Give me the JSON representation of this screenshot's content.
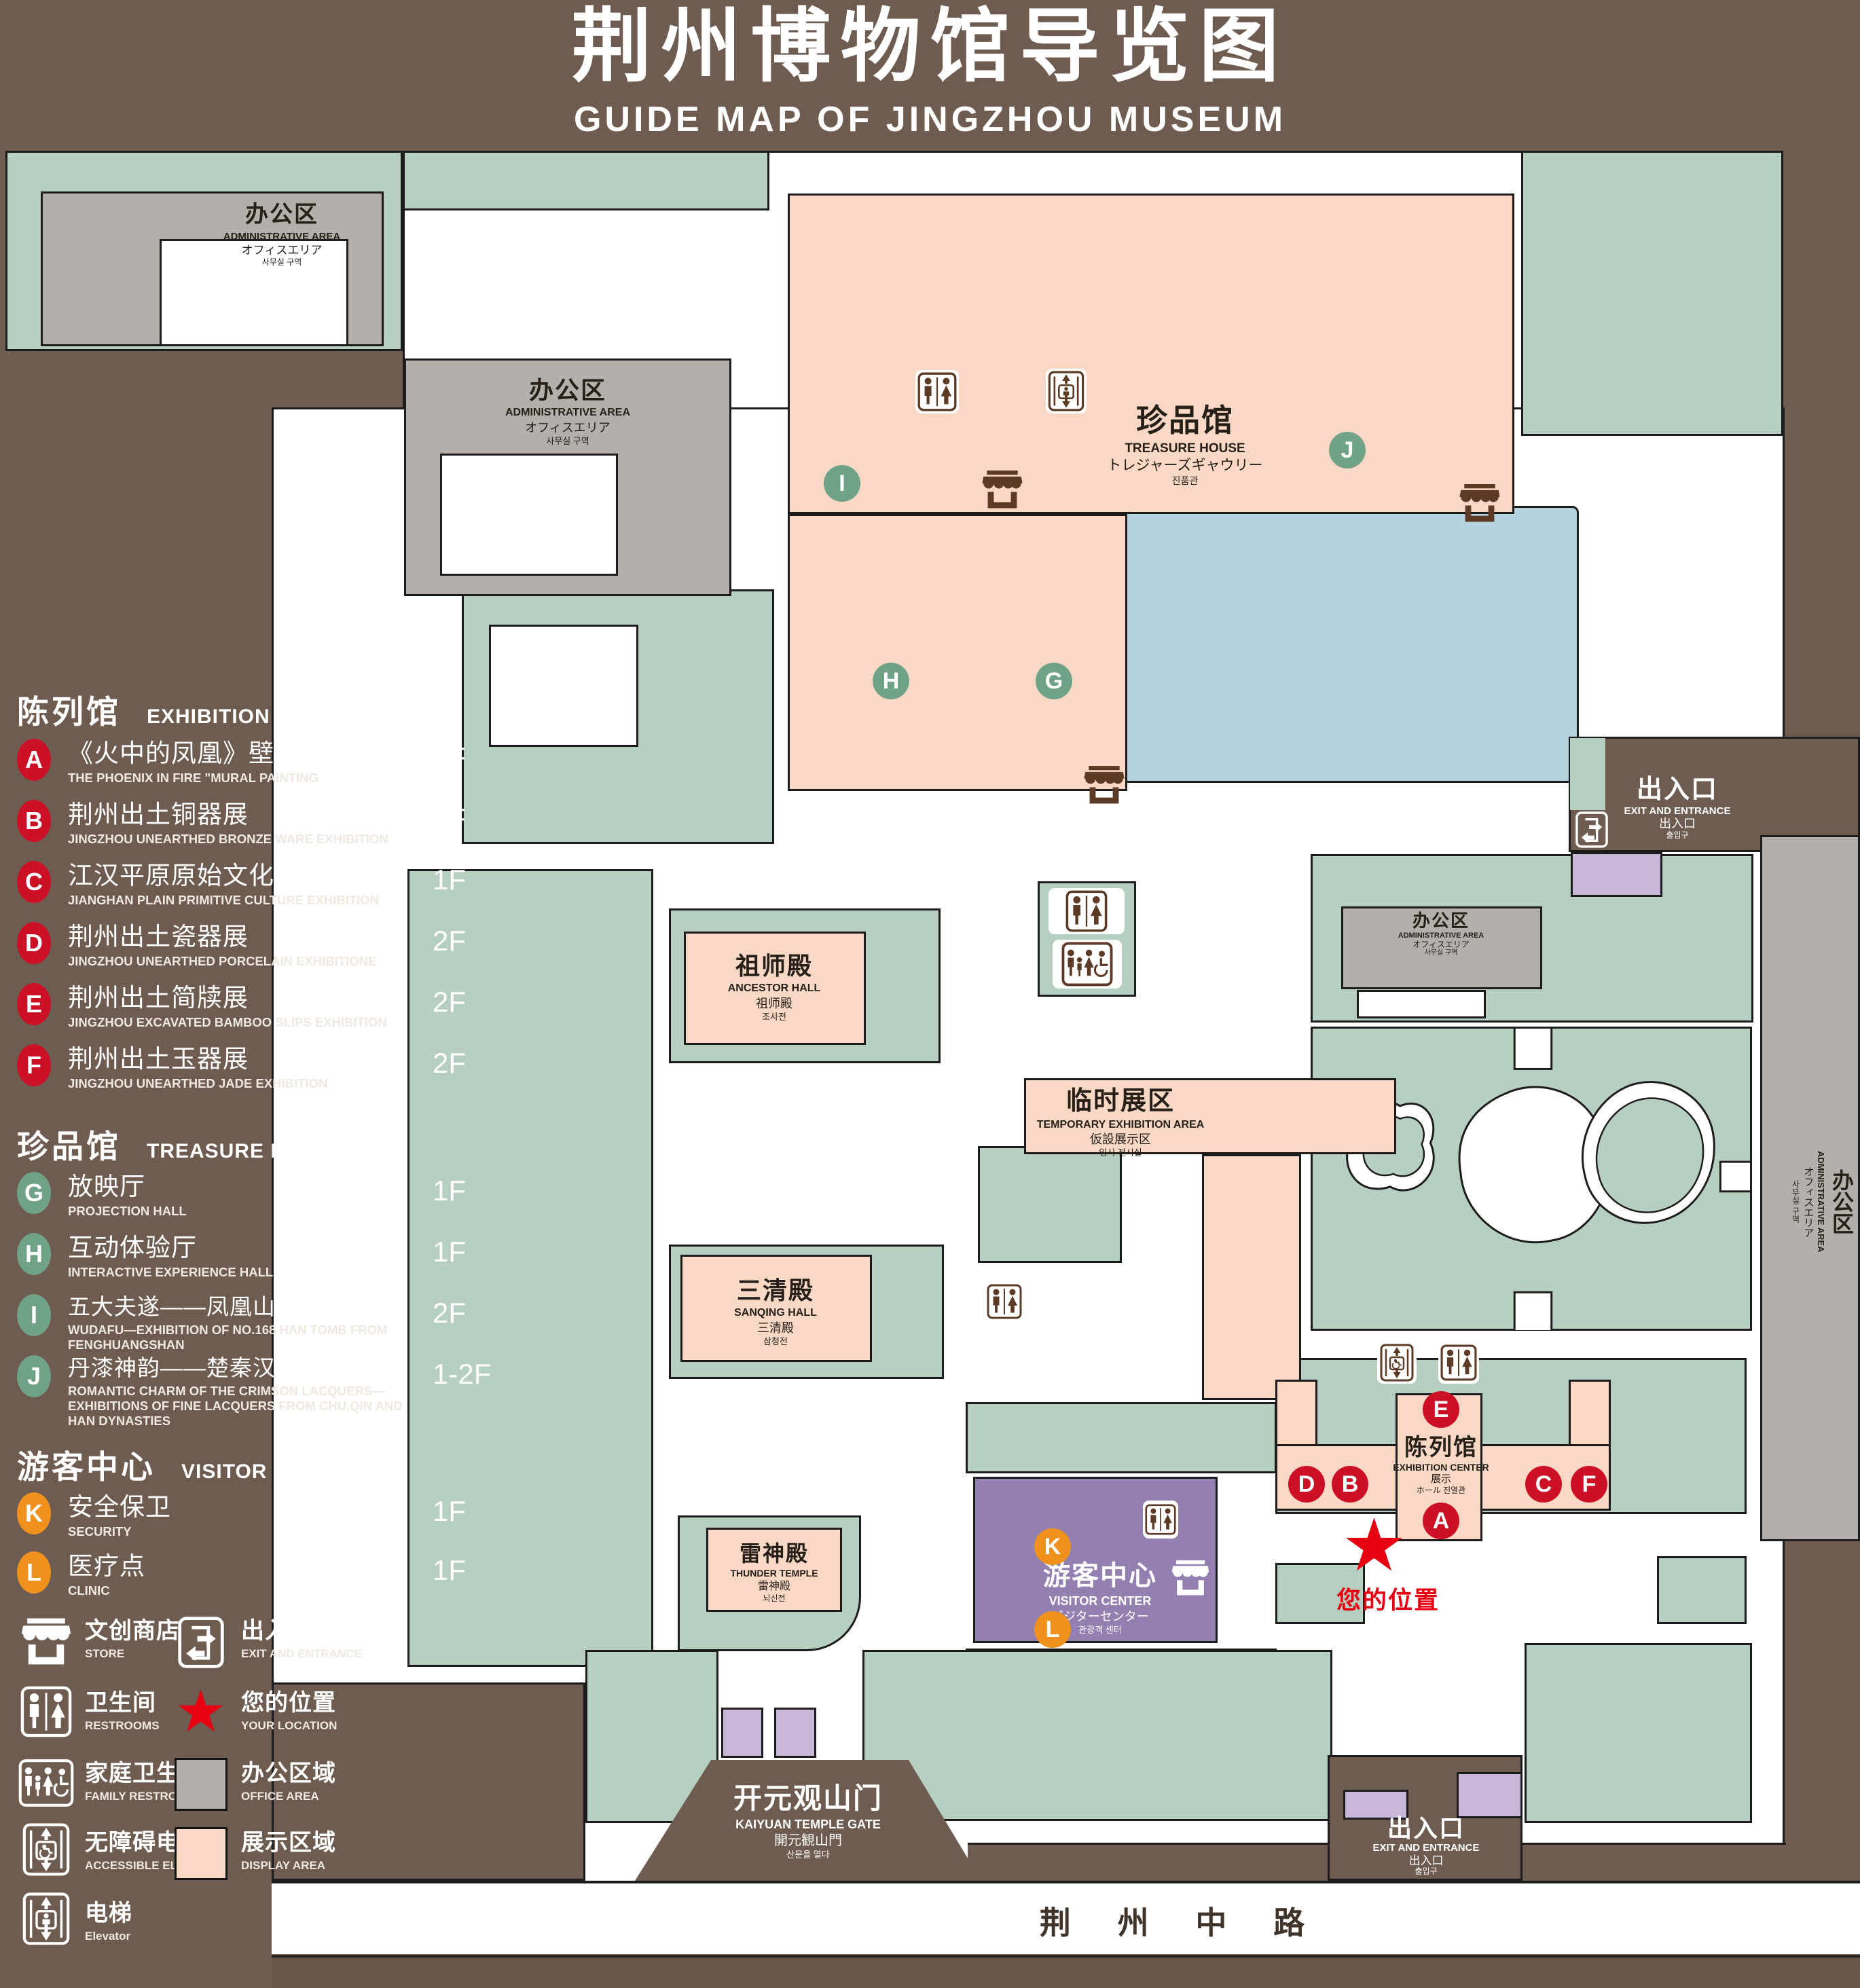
{
  "title": {
    "zh": "荆州博物馆导览图",
    "en": "GUIDE MAP OF JINGZHOU MUSEUM"
  },
  "colors": {
    "background": "#6E5C50",
    "landscape_green": "#B6CFC1",
    "display_area_peach": "#F9D8C6",
    "office_gray": "#B4AFAB",
    "visitor_center_purple": "#9480B0",
    "gate_purple": "#C9B7DA",
    "pond_blue": "#B5D3DF",
    "badge_red": "#CC1126",
    "badge_green": "#6FA287",
    "badge_orange": "#F0901D",
    "location_red": "#E60012",
    "outline_black": "#1C1C1C",
    "icon_brown": "#5C3B26"
  },
  "legend": {
    "sections": [
      {
        "title_zh": "陈列馆",
        "title_en": "EXHIBITION CENTER",
        "badge_color": "#CC1126",
        "items": [
          {
            "letter": "A",
            "zh": "《火中的凤凰》壁画",
            "en": "THE PHOENIX IN FIRE \"MURAL PAINTING",
            "floor": "1F"
          },
          {
            "letter": "B",
            "zh": "荆州出土铜器展",
            "en": "JINGZHOU UNEARTHED BRONZE WARE EXHIBITION",
            "floor": "1F"
          },
          {
            "letter": "C",
            "zh": "江汉平原原始文化展",
            "en": "JIANGHAN PLAIN PRIMITIVE CULTURE EXHIBITION",
            "floor": "1F"
          },
          {
            "letter": "D",
            "zh": "荆州出土瓷器展",
            "en": "JINGZHOU UNEARTHED PORCELAIN EXHIBITIONE",
            "floor": "2F"
          },
          {
            "letter": "E",
            "zh": "荆州出土简牍展",
            "en": "JINGZHOU EXCAVATED BAMBOO SLIPS EXHIBITION",
            "floor": "2F"
          },
          {
            "letter": "F",
            "zh": "荆州出土玉器展",
            "en": "JINGZHOU UNEARTHED JADE EXHIBITION",
            "floor": "2F"
          }
        ]
      },
      {
        "title_zh": "珍品馆",
        "title_en": "TREASURE HOUSE",
        "badge_color": "#6FA287",
        "items": [
          {
            "letter": "G",
            "zh": "放映厅",
            "en": "PROJECTION HALL",
            "floor": "1F"
          },
          {
            "letter": "H",
            "zh": "互动体验厅",
            "en": "INTERACTIVE EXPERIENCE HALL",
            "floor": "1F"
          },
          {
            "letter": "I",
            "zh": "五大夫遂——凤凰山168号汉墓展",
            "en": "WUDAFU—EXHIBITION OF NO.168 HAN TOMB FROM FENGHUANGSHAN",
            "floor": "2F"
          },
          {
            "letter": "J",
            "zh": "丹漆神韵——楚秦汉漆器精品展",
            "en": "ROMANTIC CHARM OF THE CRIMSON LACQUERS—EXHIBITIONS OF FINE LACQUERS FROM CHU,QIN AND HAN DYNASTIES",
            "floor": "1-2F"
          }
        ]
      },
      {
        "title_zh": "游客中心",
        "title_en": "VISITOR CENTER",
        "badge_color": "#F0901D",
        "items": [
          {
            "letter": "K",
            "zh": "安全保卫",
            "en": "SECURITY",
            "floor": "1F"
          },
          {
            "letter": "L",
            "zh": "医疗点",
            "en": "CLINIC",
            "floor": "1F"
          }
        ]
      }
    ],
    "symbols": [
      {
        "icon": "store-icon",
        "zh": "文创商店",
        "en": "STORE"
      },
      {
        "icon": "exit-icon",
        "zh": "出入口",
        "en": "EXIT AND ENTRANCE"
      },
      {
        "icon": "restrooms-icon",
        "zh": "卫生间",
        "en": "RESTROOMS"
      },
      {
        "icon": "location-star",
        "zh": "您的位置",
        "en": "YOUR LOCATION"
      },
      {
        "icon": "family-restrooms-icon",
        "zh": "家庭卫生间",
        "en": "FAMILY RESTROOMS"
      },
      {
        "icon": "office-swatch",
        "zh": "办公区域",
        "en": "OFFICE AREA"
      },
      {
        "icon": "accessible-elevator-icon",
        "zh": "无障碍电梯",
        "en": "ACCESSIBLE ELEVATOR"
      },
      {
        "icon": "display-swatch",
        "zh": "展示区域",
        "en": "DISPLAY AREA"
      },
      {
        "icon": "elevator-icon",
        "zh": "电梯",
        "en": "Elevator"
      }
    ]
  },
  "map": {
    "buildings": {
      "treasure_house": {
        "zh": "珍品馆",
        "en": "TREASURE HOUSE",
        "jp": "トレジャーズギャウリー",
        "kr": "진품관"
      },
      "admin_area": {
        "zh": "办公区",
        "en": "ADMINISTRATIVE AREA",
        "jp": "オフィスエリア",
        "kr": "사무실 구역"
      },
      "ancestor_hall": {
        "zh": "祖师殿",
        "en": "ANCESTOR HALL",
        "jp": "祖师殿",
        "kr": "조사전"
      },
      "temporary_area": {
        "zh": "临时展区",
        "en": "TEMPORARY EXHIBITION AREA",
        "jp": "仮設展示区",
        "kr": "임시 전시실"
      },
      "sanqing_hall": {
        "zh": "三清殿",
        "en": "SANQING HALL",
        "jp": "三清殿",
        "kr": "삼청전"
      },
      "thunder_temple": {
        "zh": "雷神殿",
        "en": "THUNDER TEMPLE",
        "jp": "雷神殿",
        "kr": "뇌신전"
      },
      "visitor_center": {
        "zh": "游客中心",
        "en": "VISITOR CENTER",
        "jp": "ビジターセンター",
        "kr": "관광객 센터"
      },
      "exhibition_center": {
        "zh": "陈列馆",
        "en": "EXHIBITION CENTER",
        "jp": "展示",
        "kr": "ホール 진열관"
      },
      "gate": {
        "zh": "开元观山门",
        "en": "KAIYUAN TEMPLE GATE",
        "jp": "開元観山門",
        "kr": "산문을 열다"
      },
      "exit": {
        "zh": "出入口",
        "en": "EXIT AND ENTRANCE",
        "jp": "出入口",
        "kr": "출입구"
      }
    },
    "road": {
      "zh": "荆 州 中 路"
    }
  }
}
